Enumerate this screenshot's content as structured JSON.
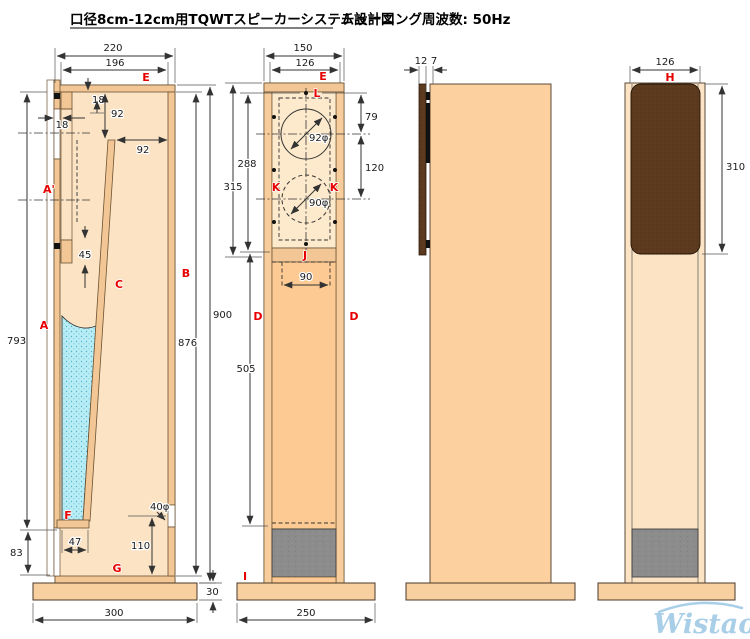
{
  "title": {
    "main": "口径8cm-12cm用TQWTスピーカーシステム設計図",
    "tuning": "チューニング周波数: 50Hz"
  },
  "colors": {
    "wood": "#FBE3C4",
    "panel": "#F3C795",
    "stuffing": "#B9EDF6",
    "stuffing_dot": "#4FB3CC",
    "mouth": "#8C8C8C",
    "grille": "#5C3A1E",
    "label_red": "#E60000",
    "dim_line": "#333333",
    "watermark": "#A9CFE8"
  },
  "views": {
    "section": {
      "labels": {
        "E": "E",
        "Ap": "A'",
        "A": "A",
        "B": "B",
        "C": "C",
        "F": "F",
        "G": "G"
      },
      "dims": {
        "w220": "220",
        "w196": "196",
        "t18_top": "18",
        "t18_side": "18",
        "v92": "92",
        "h92": "92",
        "v45": "45",
        "h793": "793",
        "h876": "876",
        "h900": "900",
        "port40": "40φ",
        "w47": "47",
        "v110": "110",
        "v83": "83",
        "w300": "300",
        "t30": "30"
      }
    },
    "front": {
      "labels": {
        "E": "E",
        "L": "L",
        "K_left": "K",
        "K_right": "K",
        "J": "J",
        "D_left": "D",
        "D_right": "D",
        "I": "I"
      },
      "dims": {
        "w150": "150",
        "w126": "126",
        "v315": "315",
        "v288": "288",
        "v79": "79",
        "v120": "120",
        "dia92": "92φ",
        "dia90": "90φ",
        "w90": "90",
        "v505": "505",
        "w250": "250"
      }
    },
    "side": {
      "dims": {
        "t12": "12",
        "g7": "7"
      }
    },
    "back": {
      "labels": {
        "H": "H"
      },
      "dims": {
        "w126": "126",
        "v310": "310"
      }
    }
  },
  "watermark": {
    "text": "Wistao"
  }
}
